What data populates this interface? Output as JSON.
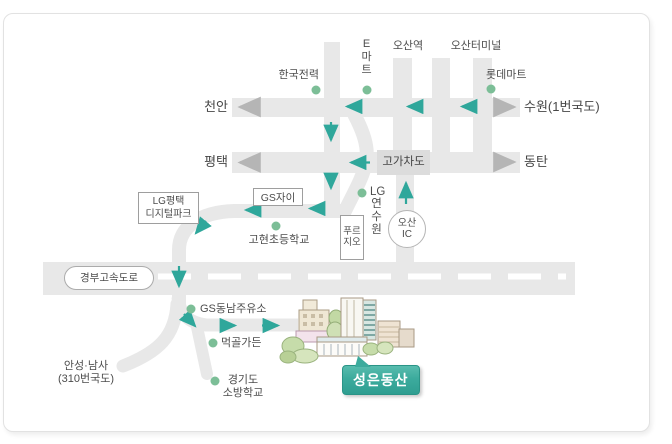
{
  "colors": {
    "road": "#e8e8e8",
    "road_box": "#dcdcdc",
    "arrow_teal": "#2fa79b",
    "arrow_gray": "#b5b5b5",
    "dot_green": "#7cbe97",
    "badge_teal": "#3cab9d",
    "text": "#4c4c4c",
    "panel_border": "#e2e2e2",
    "dash_white": "#ffffff"
  },
  "landmarks": {
    "kepco": "한국전력",
    "emart": "E마트",
    "osan_station": "오산역",
    "osan_terminal": "오산터미널",
    "lotte_mart": "롯데마트",
    "lg_digital_park_line1": "LG평택",
    "lg_digital_park_line2": "디지털파크",
    "gs_xi": "GS자이",
    "lg_training_prefix": "LG",
    "lg_training_rest": "연수원",
    "prugio": "푸르지오",
    "gohyeon_school": "고현초등학교",
    "gs_gas_station": "GS동남주유소",
    "meokgol_garden": "먹골가든",
    "fire_school_line1": "경기도",
    "fire_school_line2": "소방학교"
  },
  "roads": {
    "overpass": "고가차도",
    "expressway": "경부고속도로",
    "osan_ic_line1": "오산",
    "osan_ic_line2": "IC"
  },
  "directions": {
    "cheonan": "천안",
    "pyeongtaek": "평택",
    "suwon_route1": "수원(1번국도)",
    "dongtan": "동탄",
    "anseong_line1": "안성·남사",
    "anseong_line2": "(310번국도)"
  },
  "destination": {
    "badge_label": "성은동산"
  }
}
